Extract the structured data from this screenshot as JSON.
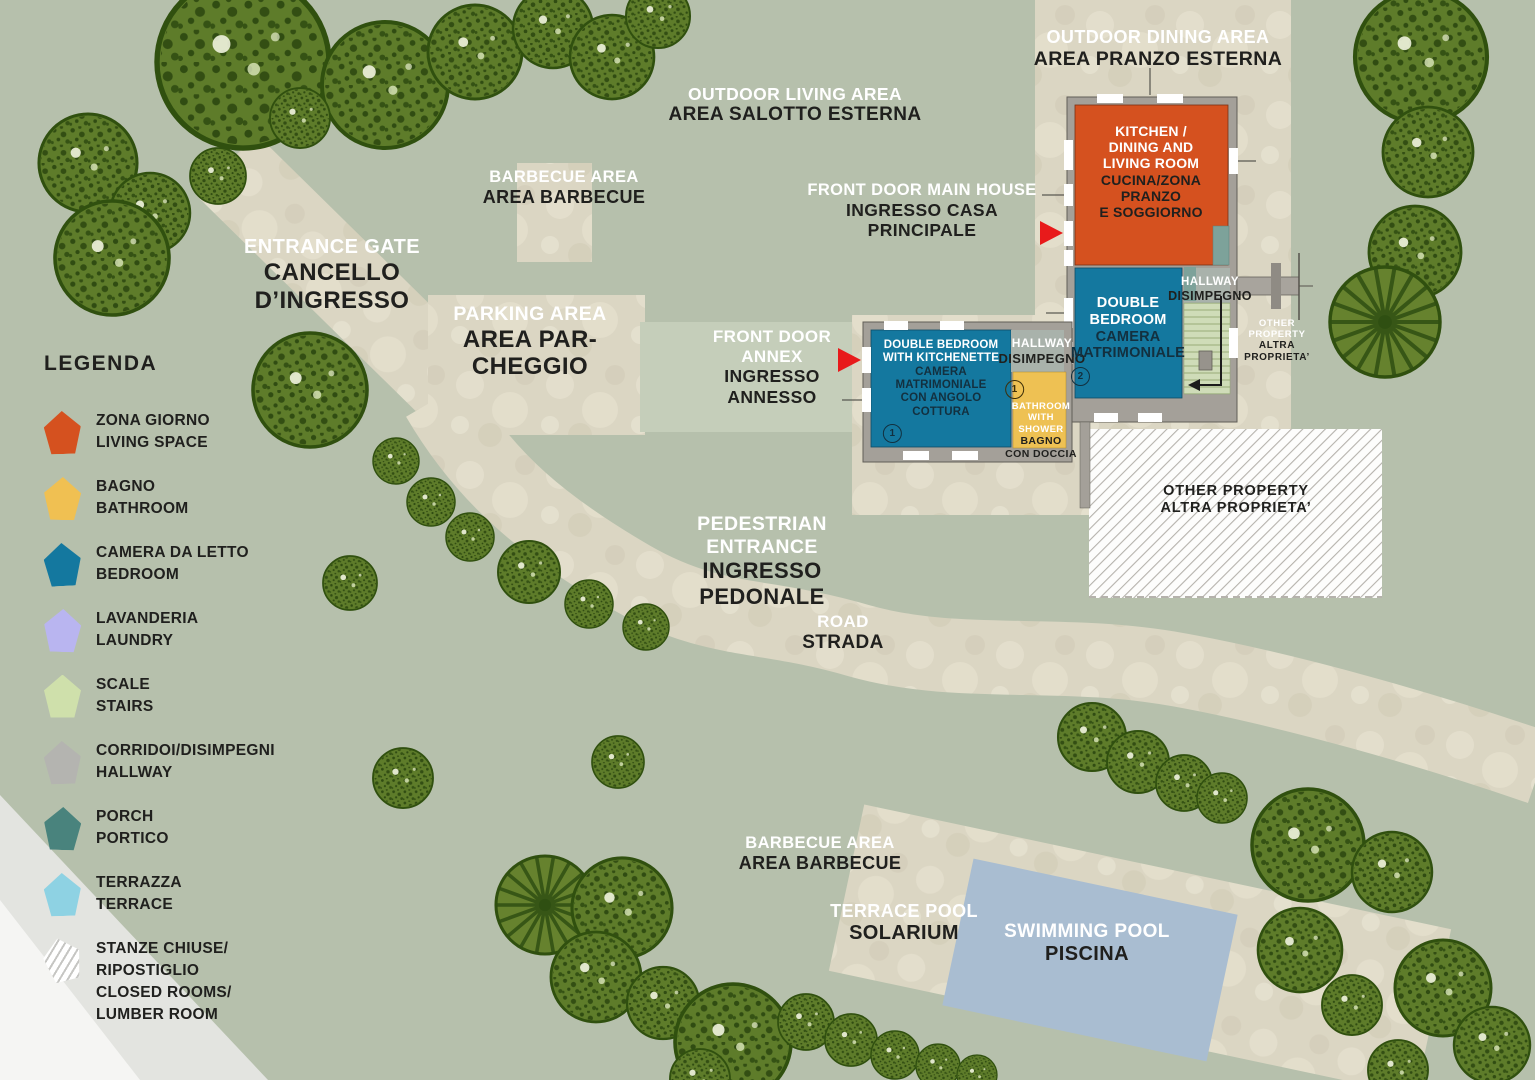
{
  "legend": {
    "title": "LEGENDA",
    "items": [
      {
        "id": "living",
        "lines": [
          "ZONA GIORNO",
          "LIVING SPACE"
        ],
        "color": "#d5511f"
      },
      {
        "id": "bathroom",
        "lines": [
          "BAGNO",
          "BATHROOM"
        ],
        "color": "#f0c052"
      },
      {
        "id": "bedroom",
        "lines": [
          "CAMERA DA LETTO",
          "BEDROOM"
        ],
        "color": "#14789f"
      },
      {
        "id": "laundry",
        "lines": [
          "LAVANDERIA",
          "LAUNDRY"
        ],
        "color": "#b9b5f0"
      },
      {
        "id": "stairs",
        "lines": [
          "SCALE",
          "STAIRS"
        ],
        "color": "#cfe0ab"
      },
      {
        "id": "hallway",
        "lines": [
          "CORRIDOI/DISIMPEGNI",
          "HALLWAY"
        ],
        "color": "#b4b4b0"
      },
      {
        "id": "porch",
        "lines": [
          "PORCH",
          "PORTICO"
        ],
        "color": "#49837d"
      },
      {
        "id": "terrace",
        "lines": [
          "TERRAZZA",
          "TERRACE"
        ],
        "color": "#8ed2e3"
      },
      {
        "id": "closed",
        "lines": [
          "STANZE CHIUSE/",
          "RIPOSTIGLIO",
          "CLOSED ROOMS/",
          "LUMBER ROOM"
        ],
        "color": "#ffffff"
      }
    ]
  },
  "labels": {
    "outdoor_dining": {
      "en": [
        "OUTDOOR DINING AREA"
      ],
      "it": [
        "AREA PRANZO ESTERNA"
      ]
    },
    "outdoor_living": {
      "en": [
        "OUTDOOR LIVING AREA"
      ],
      "it": [
        "AREA SALOTTO ESTERNA"
      ]
    },
    "barbecue_top": {
      "en": [
        "BARBECUE AREA"
      ],
      "it": [
        "AREA BARBECUE"
      ]
    },
    "front_door_main": {
      "en": [
        "FRONT DOOR MAIN HOUSE"
      ],
      "it": [
        "INGRESSO CASA",
        "PRINCIPALE"
      ]
    },
    "entrance_gate": {
      "en": [
        "ENTRANCE GATE"
      ],
      "it": [
        "CANCELLO",
        "D’INGRESSO"
      ]
    },
    "parking": {
      "en": [
        "PARKING AREA"
      ],
      "it": [
        "AREA PAR-",
        "CHEGGIO"
      ]
    },
    "front_door_annex": {
      "en": [
        "FRONT DOOR",
        "ANNEX"
      ],
      "it": [
        "INGRESSO",
        "ANNESSO"
      ]
    },
    "pedestrian": {
      "en": [
        "PEDESTRIAN",
        "ENTRANCE"
      ],
      "it": [
        "INGRESSO",
        "PEDONALE"
      ]
    },
    "road": {
      "en": [
        "ROAD"
      ],
      "it": [
        "STRADA"
      ]
    },
    "barbecue_bottom": {
      "en": [
        "BARBECUE AREA"
      ],
      "it": [
        "AREA BARBECUE"
      ]
    },
    "terrace_pool": {
      "en": [
        "TERRACE POOL"
      ],
      "it": [
        "SOLARIUM"
      ]
    },
    "swimming_pool": {
      "en": [
        "SWIMMING POOL"
      ],
      "it": [
        "PISCINA"
      ]
    },
    "other_property_small": {
      "en": [
        "OTHER",
        "PROPERTY"
      ],
      "it": [
        "ALTRA",
        "PROPRIETA’"
      ]
    },
    "other_property_hatched": {
      "lines": [
        "OTHER PROPERTY",
        "ALTRA PROPRIETA’"
      ]
    },
    "hallway_main": {
      "en": [
        "HALLWAY"
      ],
      "it": [
        "DISIMPEGNO"
      ]
    },
    "hallway_annex": {
      "en": [
        "HALLWAY"
      ],
      "it": [
        "DISIMPEGNO"
      ]
    }
  },
  "rooms": {
    "kitchen": {
      "en": [
        "KITCHEN /",
        "DINING AND",
        "LIVING ROOM"
      ],
      "it": [
        "CUCINA/ZONA",
        "PRANZO",
        "E SOGGIORNO"
      ]
    },
    "bedroom_main": {
      "en": [
        "DOUBLE",
        "BEDROOM"
      ],
      "it": [
        "CAMERA",
        "MATRIMONIALE"
      ],
      "num": "2"
    },
    "bedroom_annex": {
      "en": [
        "DOUBLE BEDROOM",
        "WITH KITCHENETTE"
      ],
      "it": [
        "CAMERA",
        "MATRIMONIALE",
        "CON ANGOLO",
        "COTTURA"
      ],
      "num": "1"
    },
    "bathroom_annex": {
      "num": "1",
      "en": [
        "BATHROOM",
        "WITH",
        "SHOWER"
      ],
      "it": [
        "BAGNO",
        "CON DOCCIA"
      ]
    }
  },
  "colors": {
    "background": "#b6c0ac",
    "path_beige": "#dbd6c3",
    "living_orange": "#d5511f",
    "bathroom_yellow": "#f0c052",
    "bedroom_blue": "#14789f",
    "laundry_lavender": "#b9b5f0",
    "stairs_green": "#cfe0ab",
    "hallway_gray": "#b4b4b0",
    "porch_teal": "#49837d",
    "terrace_lightblue": "#8ed2e3",
    "pool_blue": "#a9bdd1",
    "tree_green": "#5e7c2a",
    "arrow_red": "#e81a1b",
    "wall_gray": "#a4a099",
    "text_dark": "#20201e",
    "text_light": "#ffffff"
  }
}
